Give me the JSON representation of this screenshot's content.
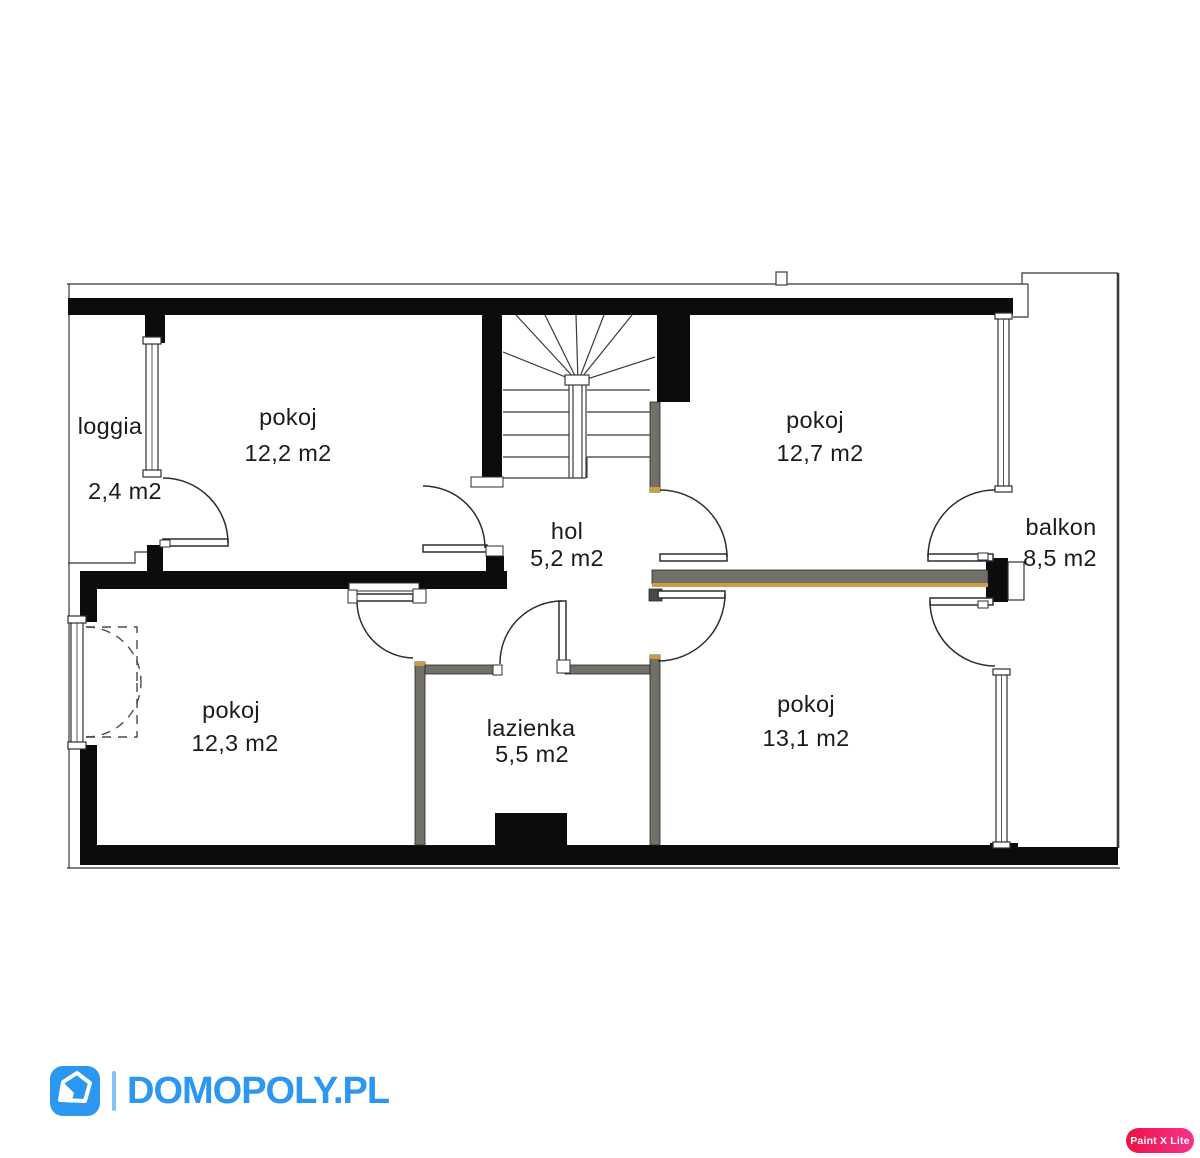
{
  "plan": {
    "rooms": [
      {
        "id": "loggia",
        "name": "loggia",
        "area": "2,4 m2"
      },
      {
        "id": "pokoj-12-2",
        "name": "pokoj",
        "area": "12,2 m2"
      },
      {
        "id": "pokoj-12-7",
        "name": "pokoj",
        "area": "12,7 m2"
      },
      {
        "id": "balkon",
        "name": "balkon",
        "area": "8,5 m2"
      },
      {
        "id": "hol",
        "name": "hol",
        "area": "5,2 m2"
      },
      {
        "id": "pokoj-12-3",
        "name": "pokoj",
        "area": "12,3 m2"
      },
      {
        "id": "lazienka",
        "name": "lazienka",
        "area": "5,5 m2"
      },
      {
        "id": "pokoj-13-1",
        "name": "pokoj",
        "area": "13,1 m2"
      }
    ],
    "features": [
      "staircase",
      "windows",
      "doors",
      "chimney-duct"
    ],
    "colors": {
      "wall": "#0c0c0c",
      "partition_gray": "#737069",
      "partition_accent_orange": "#cf9b3f",
      "thin_line": "#555555"
    }
  },
  "branding": {
    "site_name": "DOMOPOLY.PL",
    "logo_icon": "house-icon",
    "accent_color": "#2b97f1",
    "separator_color": "#87c1f6"
  },
  "watermark": {
    "label": "Paint X Lite",
    "color_start": "#ef1243",
    "color_end": "#f5338b"
  }
}
